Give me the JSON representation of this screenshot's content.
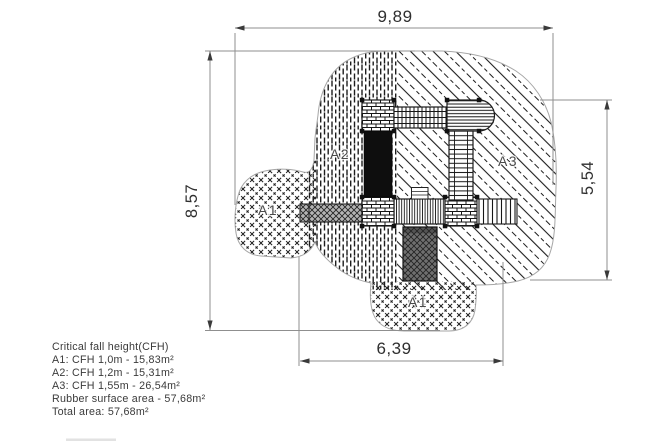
{
  "drawing": {
    "dimensions": {
      "top": "9,89",
      "left": "8,57",
      "right": "5,54",
      "bottom": "6,39"
    },
    "area_labels": {
      "a1_left": "A1",
      "a2": "A2",
      "a3": "A3",
      "a1_bottom": "A1"
    },
    "legend": {
      "title": "Critical fall height(CFH)",
      "items": [
        "A1: CFH 1,0m - 15,83m²",
        "A2: CFH 1,2m - 15,31m²",
        "A3: CFH 1,55m - 26,54m²",
        "Rubber surface area - 57,68m²",
        "Total area: 57,68m²"
      ]
    },
    "colors": {
      "blob_outline": "#a6a6a6",
      "hatch": "#1d1d1d",
      "dim_line": "#8f8f8f",
      "dim_text": "#2f2f2f",
      "area_label": "#4a4a4a",
      "slide_gray": "#b4b4b4",
      "climb_wall_gray": "#6f6f6f",
      "equipment_black": "#0e0e0e"
    }
  }
}
